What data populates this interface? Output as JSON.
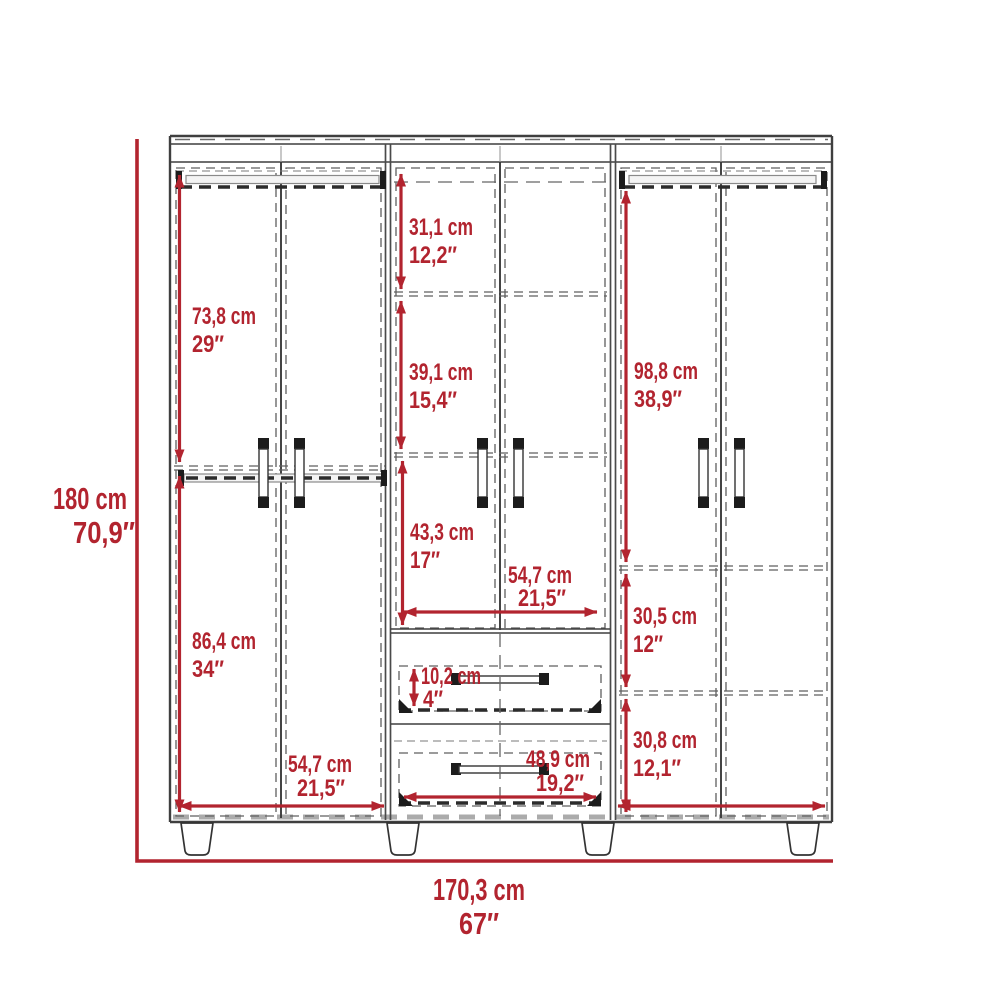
{
  "colors": {
    "dim_red": "#b2242f",
    "line_dark": "#3f3f3f"
  },
  "diagram": {
    "kind": "wardrobe dimension drawing",
    "dims": {
      "total_height": {
        "cm": "180 cm",
        "in": "70,9″"
      },
      "total_width": {
        "cm": "170,3 cm",
        "in": "67″"
      },
      "left_upper_height": {
        "cm": "73,8 cm",
        "in": "29″"
      },
      "left_lower_height": {
        "cm": "86,4 cm",
        "in": "34″"
      },
      "left_section_width": {
        "cm": "54,7 cm",
        "in": "21,5″"
      },
      "center_top_height": {
        "cm": "31,1 cm",
        "in": "12,2″"
      },
      "center_mid_height": {
        "cm": "39,1 cm",
        "in": "15,4″"
      },
      "center_lower_height": {
        "cm": "43,3 cm",
        "in": "17″"
      },
      "center_section_width": {
        "cm": "54,7 cm",
        "in": "21,5″"
      },
      "drawer_front_height": {
        "cm": "10,2 cm",
        "in": "4″"
      },
      "drawer_width": {
        "cm": "48,9 cm",
        "in": "19,2″"
      },
      "right_upper_height": {
        "cm": "98,8 cm",
        "in": "38,9″"
      },
      "right_gap_upper": {
        "cm": "30,5 cm",
        "in": "12″"
      },
      "right_gap_lower": {
        "cm": "30,8 cm",
        "in": "12,1″"
      }
    }
  }
}
